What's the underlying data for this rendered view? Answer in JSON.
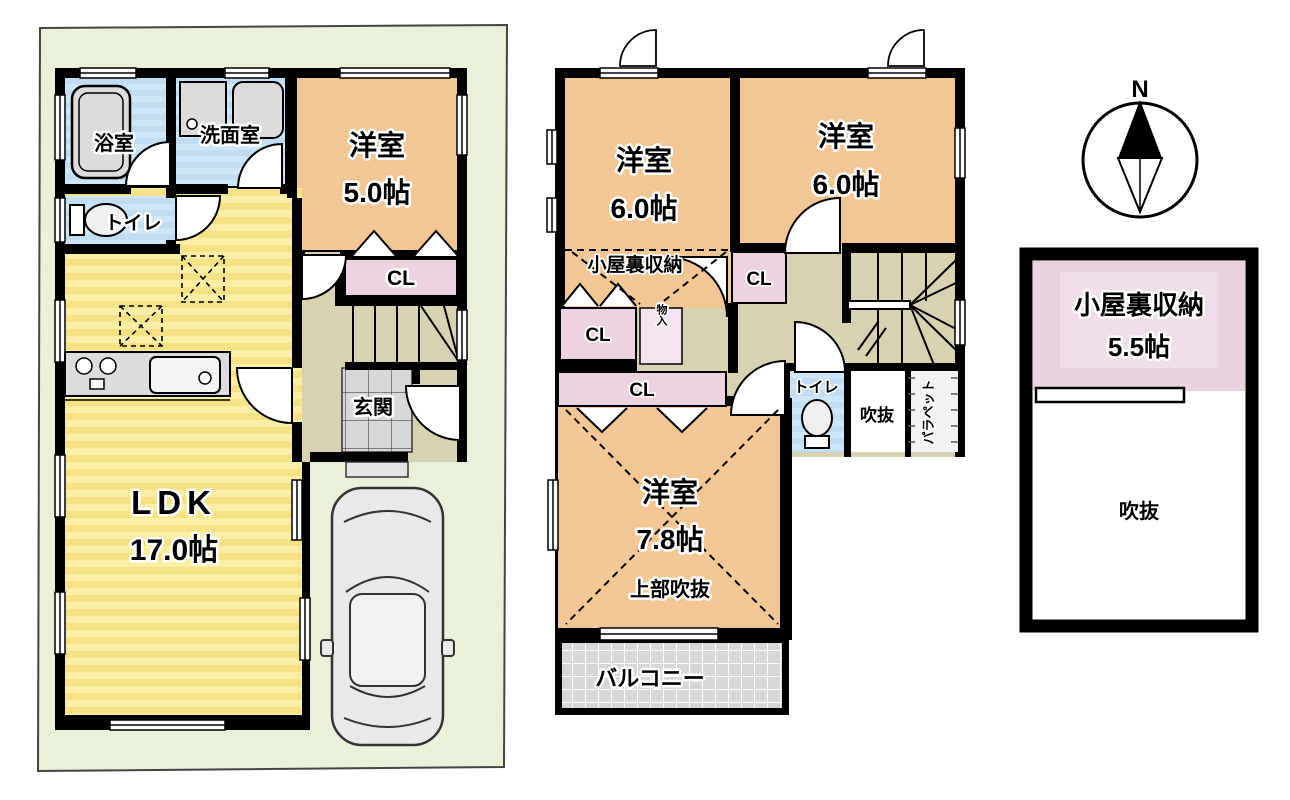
{
  "palette": {
    "site_green": "#e9f1da",
    "wall_black": "#000000",
    "room_orange": "#f3c795",
    "ldk_yellow": "#f6e286",
    "ldk_yellow_light": "#fbeea6",
    "wet_blue": "#c2ddf2",
    "wet_blue_light": "#cde6f8",
    "closet_pink": "#ecd3df",
    "attic_pink": "#e9d3df",
    "hall_khaki": "#d6d2b2",
    "tile_gray": "#d8d8d8",
    "fixture_gray": "#dcdcdc"
  },
  "floor1": {
    "bath": "浴室",
    "washroom": "洗面室",
    "toilet": "トイレ",
    "western_room": "洋室",
    "western_room_size": "5.0帖",
    "closet": "CL",
    "ldk": "LDK",
    "ldk_size": "17.0帖",
    "entrance": "玄関"
  },
  "floor2": {
    "western_room_left": "洋室",
    "western_room_left_size": "6.0帖",
    "western_room_right": "洋室",
    "western_room_right_size": "6.0帖",
    "attic_storage_note": "小屋裏収納",
    "closet_upper": "CL",
    "closet_left": "CL",
    "closet_long": "CL",
    "storage_small": "物入",
    "toilet": "トイレ",
    "void": "吹抜",
    "parapet": "パラペット",
    "western_room_big": "洋室",
    "western_room_big_size": "7.8帖",
    "upper_void": "上部吹抜",
    "balcony": "バルコニー"
  },
  "attic": {
    "storage": "小屋裏収納",
    "storage_size": "5.5帖",
    "void": "吹抜"
  },
  "compass": {
    "north": "N"
  }
}
